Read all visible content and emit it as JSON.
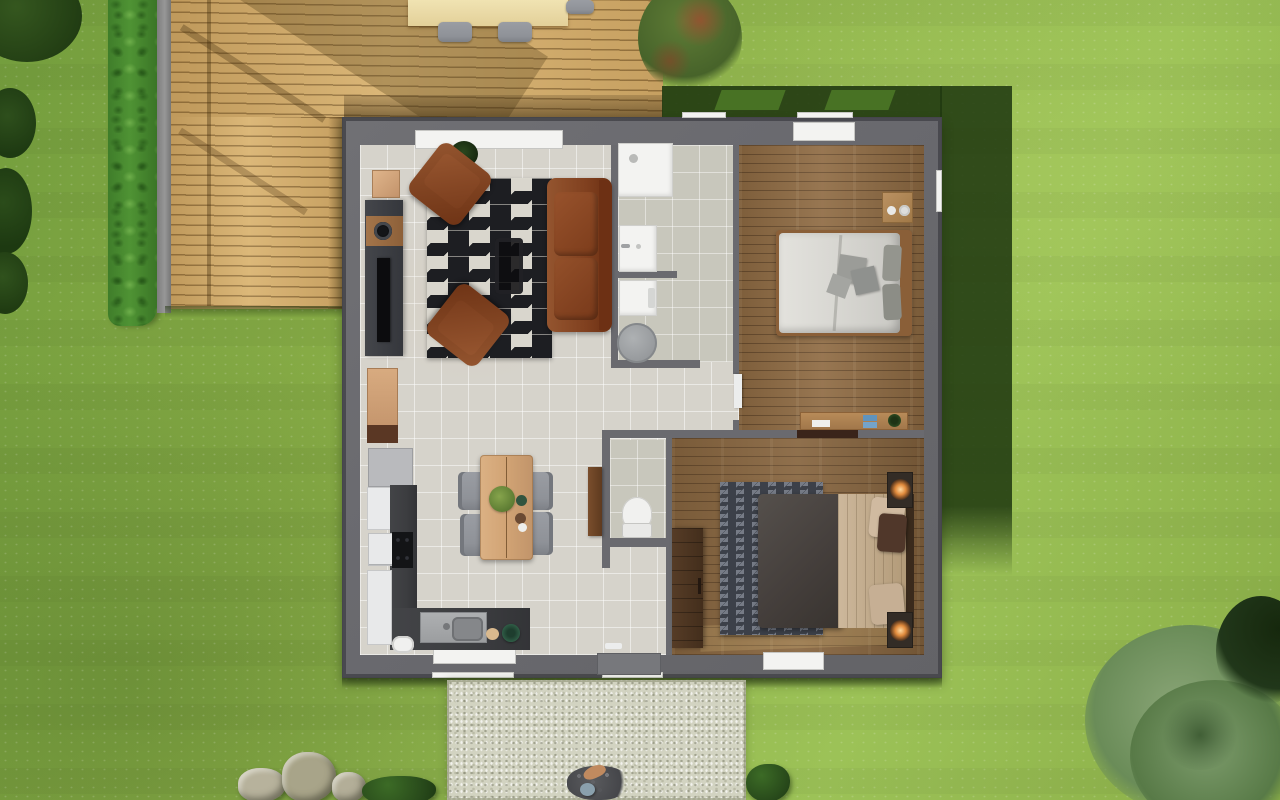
{
  "scene": {
    "type": "aerial-3d-floorplan-render",
    "view": "top-down",
    "house": {
      "exterior": [
        "deck-terrace",
        "hedge",
        "lawn",
        "gravel-path",
        "outdoor-dining-set",
        "rocks",
        "bushes",
        "trees"
      ],
      "rooms": [
        {
          "name": "living-room",
          "floor": "light-tile",
          "furniture": [
            "sofa",
            "armchair",
            "armchair",
            "zigzag-rug",
            "coffee-table",
            "tv-unit",
            "wall-clock",
            "sideboard",
            "corner-plant"
          ]
        },
        {
          "name": "kitchen-dining",
          "floor": "light-tile",
          "furniture": [
            "bookshelf",
            "fridge",
            "oven",
            "cooktop",
            "counter",
            "sink",
            "dining-table",
            "chair",
            "chair",
            "chair",
            "chair",
            "table-plant"
          ]
        },
        {
          "name": "bathroom",
          "floor": "green-tile",
          "furniture": [
            "shower",
            "washbasin",
            "washing-machine",
            "laundry-basket"
          ]
        },
        {
          "name": "wc",
          "floor": "green-tile",
          "furniture": [
            "toilet",
            "door"
          ]
        },
        {
          "name": "bedroom-1",
          "floor": "wood",
          "furniture": [
            "double-bed-white",
            "nightstand",
            "desk",
            "door"
          ]
        },
        {
          "name": "bedroom-2",
          "floor": "wood",
          "furniture": [
            "double-bed-dark",
            "zigzag-rug-gray",
            "wardrobe",
            "nightstand-lamp",
            "nightstand-lamp"
          ]
        }
      ],
      "windows": [
        "living-room-top",
        "bedroom1-top",
        "kitchen-bottom",
        "bedroom2-bottom"
      ],
      "doors": [
        "front-door-threshold",
        "bathroom-door",
        "wc-door",
        "bedroom1-door",
        "bedroom2-door-lintel"
      ]
    }
  },
  "palette": {
    "grass-base": "#8aae47",
    "grass-light": "#9cc257",
    "grass-dark": "#739d3d",
    "hedge": "#4f9334",
    "deck": "#d7b06e",
    "kerb": "#8d8d8d",
    "wall": "#6a6a6f",
    "tile": "#d6d3cb",
    "bath-tile": "#c8c7bc",
    "wood1": "#8f6b43",
    "wood2": "#87653f",
    "rug-black": "#1d1e22",
    "rug-cream": "#d9d6cd",
    "rug2-base": "#3c4049",
    "rust": "#80401f",
    "rust-light": "#94552f",
    "counter": "#3c3d40",
    "chair": "#8f9298",
    "white": "#f3f3f1",
    "wood-light": "#d2a475",
    "dark-wood": "#4a3322",
    "glow": "#e08a3c",
    "path": "#d2d3c1",
    "shadow-green": "#213a11"
  }
}
